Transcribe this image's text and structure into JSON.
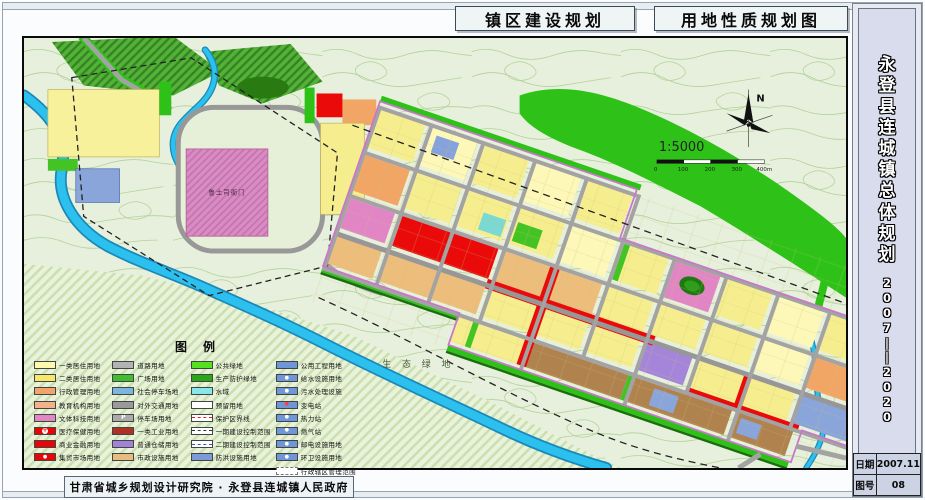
{
  "titles": {
    "left": "镇区建设规划",
    "right": "用地性质规划图"
  },
  "sidebar": {
    "title": "永登县连城镇总体规划",
    "years": "2007——2020",
    "date_label": "日期",
    "date_value": "2007.11",
    "sheet_label": "图号",
    "sheet_value": "08"
  },
  "footer": {
    "credit": "甘肃省城乡规划设计研究院 · 永登县连城镇人民政府"
  },
  "map": {
    "labels": {
      "eco": "生 态 绿 地",
      "historic": "鲁土司衙门",
      "north": "N",
      "scale": "1:5000"
    },
    "scale_ticks": [
      "0",
      "100",
      "200",
      "300",
      "400m"
    ]
  },
  "legend": {
    "title": "图例",
    "columns": [
      [
        {
          "label": "一类居住用地",
          "color": "#fdf7b0",
          "type": "fill"
        },
        {
          "label": "二类居住用地",
          "color": "#f6e86a",
          "type": "fill"
        },
        {
          "label": "行政管理用地",
          "color": "#f2a568",
          "type": "fill"
        },
        {
          "label": "教育机构用地",
          "color": "#f4b286",
          "type": "fill"
        },
        {
          "label": "文体科技用地",
          "color": "#e088c4",
          "type": "fill"
        },
        {
          "label": "医疗保健用地",
          "color": "#e80505",
          "type": "fill",
          "symbol": "medical"
        },
        {
          "label": "商业金融用地",
          "color": "#e80505",
          "type": "fill"
        },
        {
          "label": "集贸市场用地",
          "color": "#e80505",
          "type": "fill",
          "symbol": "dot"
        }
      ],
      [
        {
          "label": "道路用地",
          "color": "#b3b3b3",
          "type": "fill"
        },
        {
          "label": "广场用地",
          "color": "#3fbf30",
          "type": "fill"
        },
        {
          "label": "社会停车场地",
          "color": "#7ab6e0",
          "type": "fill"
        },
        {
          "label": "对外交通用地",
          "color": "#9a9a9a",
          "type": "fill"
        },
        {
          "label": "停车场用地",
          "color": "#ababab",
          "type": "fill",
          "symbol": "P"
        },
        {
          "label": "一类工业用地",
          "color": "#b03028",
          "type": "fill"
        },
        {
          "label": "普通仓储用地",
          "color": "#a083d8",
          "type": "fill"
        },
        {
          "label": "市政设施用地",
          "color": "#e8bc80",
          "type": "fill"
        }
      ],
      [
        {
          "label": "公共绿地",
          "color": "#55e020",
          "type": "fill"
        },
        {
          "label": "生产防护绿地",
          "color": "#28a818",
          "type": "fill"
        },
        {
          "label": "水域",
          "color": "#86e8ea",
          "type": "fill"
        },
        {
          "label": "预留用地",
          "color": "#ffffff",
          "type": "outline"
        },
        {
          "label": "保护区界线",
          "color": "#e02020",
          "type": "dash"
        },
        {
          "label": "一期建设控制范围",
          "color": "#303030",
          "type": "dash"
        },
        {
          "label": "二期建设控制范围",
          "color": "#2858c0",
          "type": "dash"
        },
        {
          "label": "防洪设施用地",
          "color": "#7a9ad8",
          "type": "fill"
        }
      ],
      [
        {
          "label": "公用工程用地",
          "color": "#6f96d6",
          "type": "fill"
        },
        {
          "label": "给水设施用地",
          "color": "#6f96d6",
          "type": "fill",
          "symbol": "dot"
        },
        {
          "label": "污水处理设施",
          "color": "#6f96d6",
          "type": "fill",
          "symbol": "dot"
        },
        {
          "label": "变电站",
          "color": "#6f96d6",
          "type": "fill",
          "symbol": "bolt"
        },
        {
          "label": "热力站",
          "color": "#6f96d6",
          "type": "fill",
          "symbol": "dot"
        },
        {
          "label": "燃气站",
          "color": "#6f96d6",
          "type": "fill",
          "symbol": "dot"
        },
        {
          "label": "邮电设施用地",
          "color": "#6f96d6",
          "type": "fill",
          "symbol": "dot"
        },
        {
          "label": "环卫设施用地",
          "color": "#6f96d6",
          "type": "fill",
          "symbol": "dot"
        },
        {
          "label": "行政辖区管理范围",
          "color": "#cccccc",
          "type": "outline-dash"
        }
      ]
    ]
  }
}
